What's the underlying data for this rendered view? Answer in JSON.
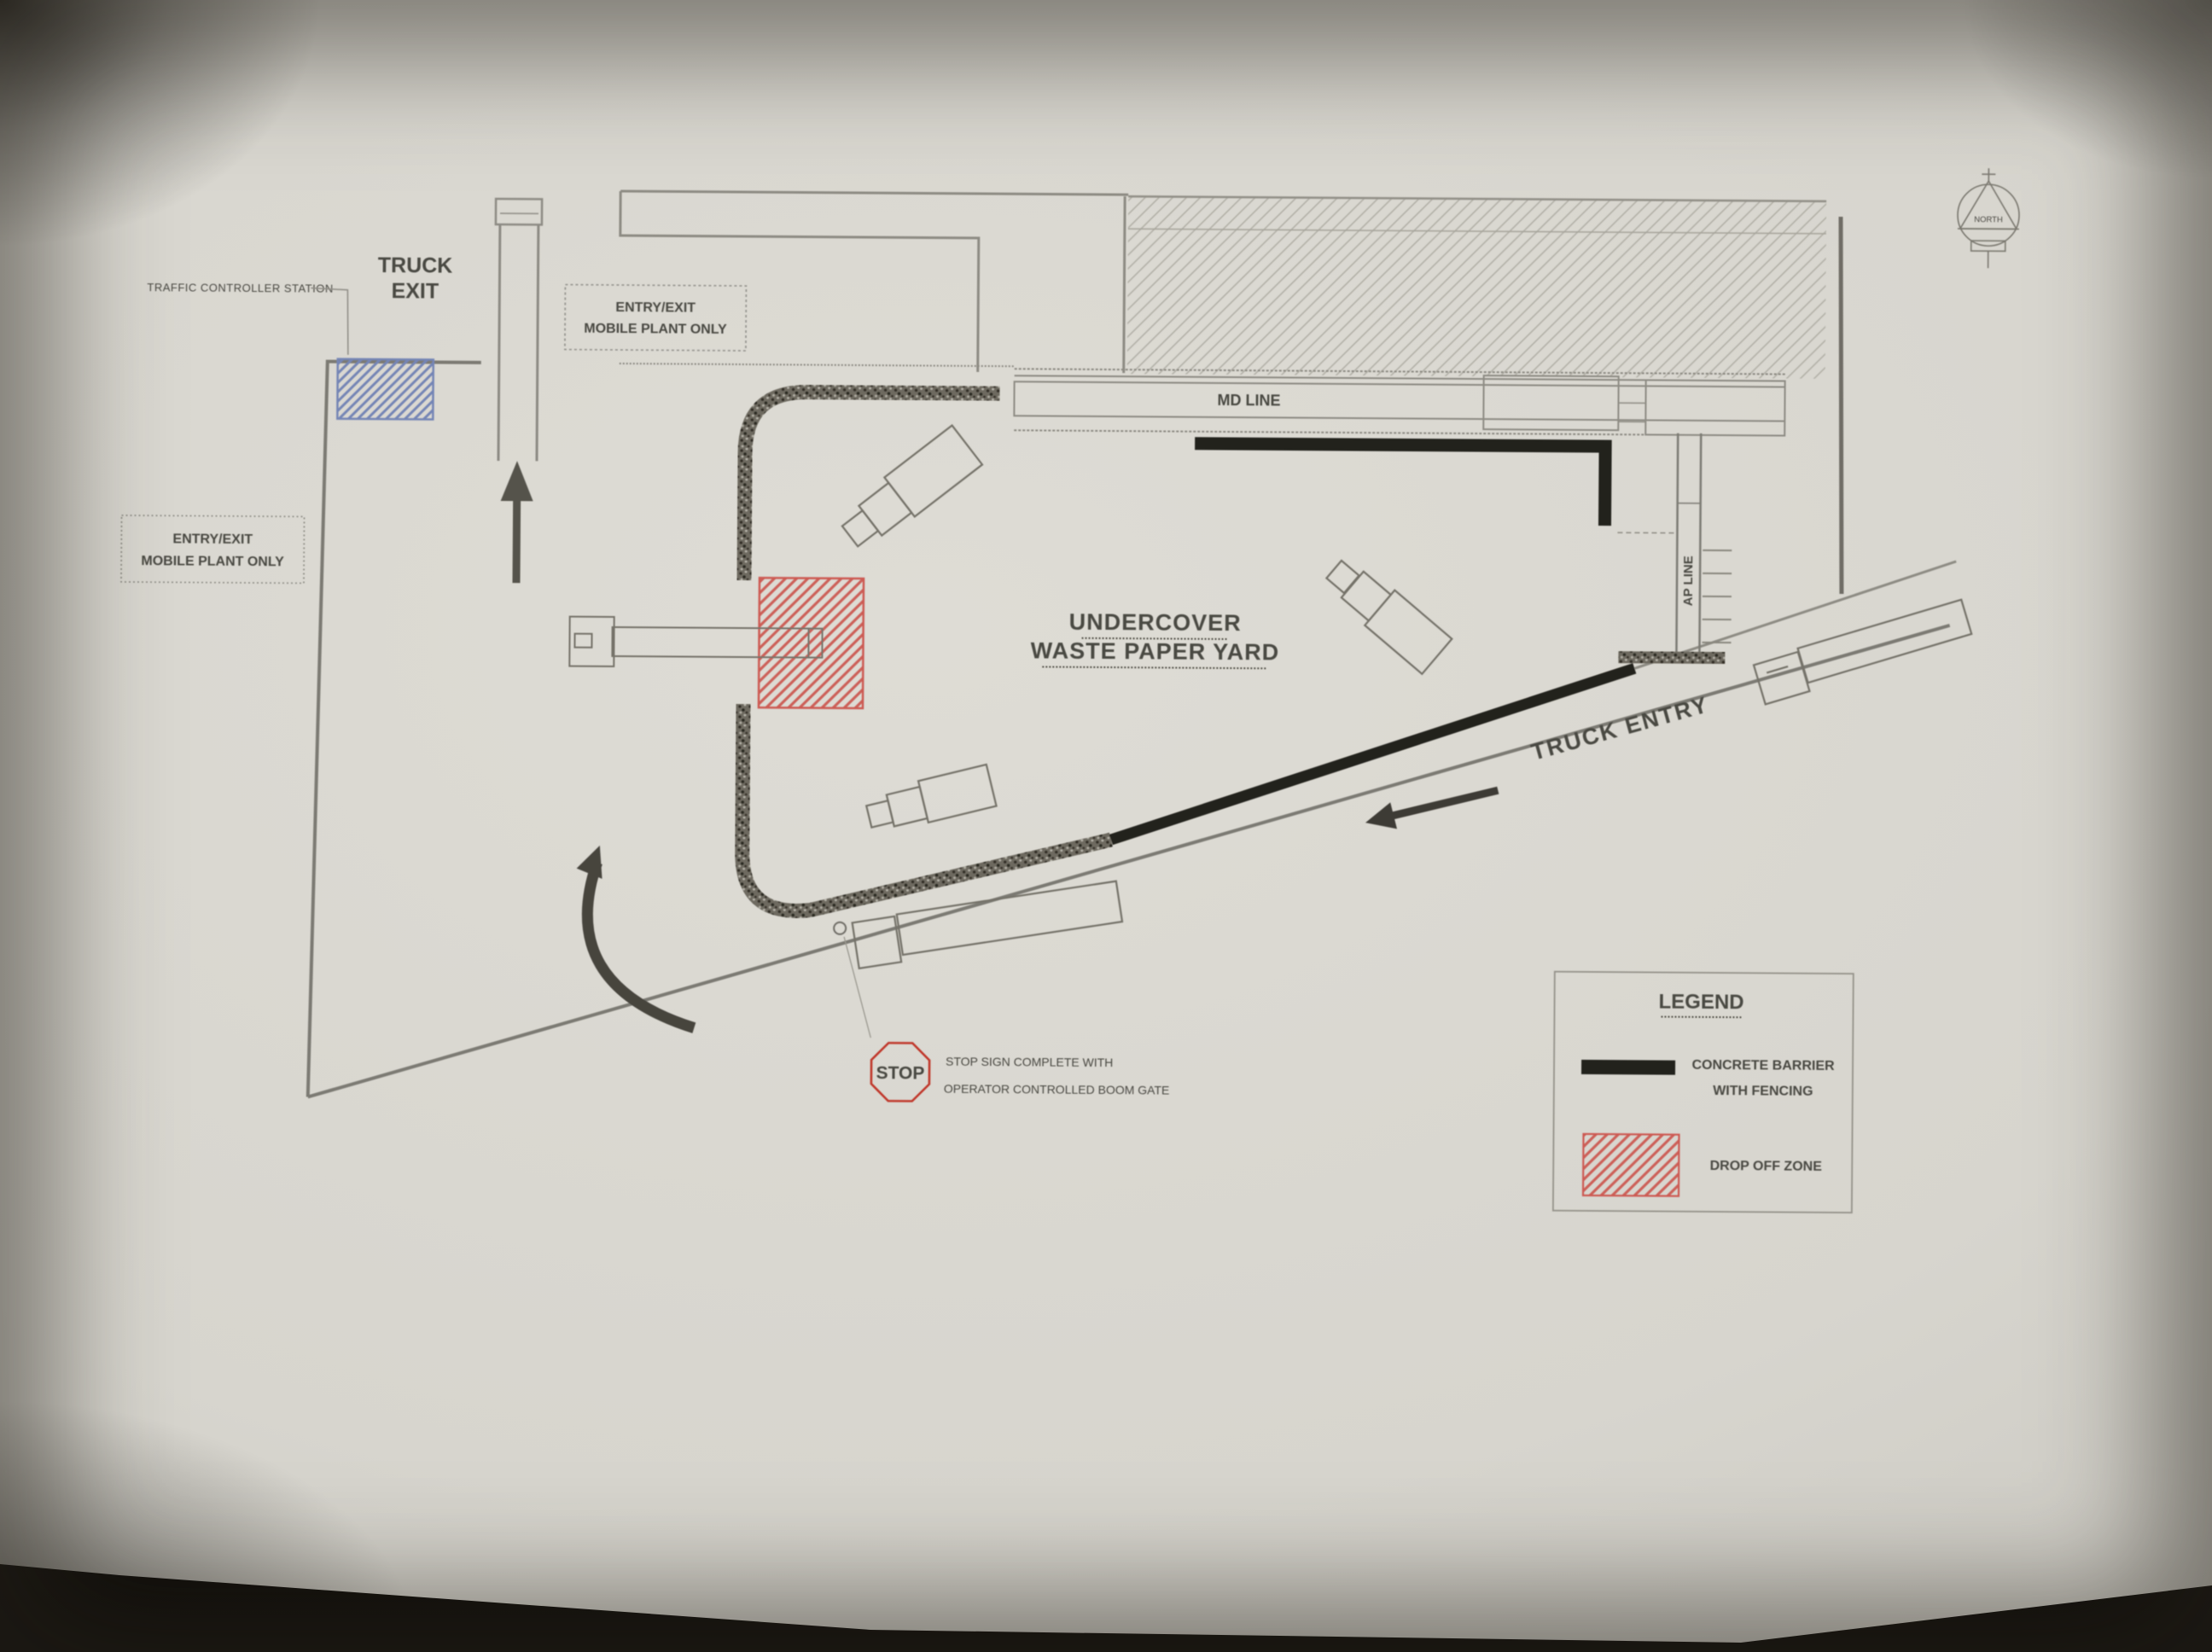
{
  "photo": {
    "surface_color": "#14110e",
    "paper_color": "#d7d5ce"
  },
  "plan": {
    "north_label": "NORTH",
    "station_label": "TRAFFIC CONTROLLER STATION",
    "truck_exit": {
      "line1": "TRUCK",
      "line2": "EXIT"
    },
    "entry_exit_top": {
      "line1": "ENTRY/EXIT",
      "line2": "MOBILE PLANT ONLY"
    },
    "entry_exit_left": {
      "line1": "ENTRY/EXIT",
      "line2": "MOBILE PLANT ONLY"
    },
    "md_line_label": "MD LINE",
    "ap_line_label": "AP LINE",
    "yard_title": {
      "line1": "UNDERCOVER",
      "line2": "WASTE PAPER YARD"
    },
    "truck_entry_label": "TRUCK ENTRY",
    "stop_sign": {
      "sign_text": "STOP",
      "note_line1": "STOP SIGN COMPLETE WITH",
      "note_line2": "OPERATOR CONTROLLED BOOM GATE"
    },
    "legend": {
      "title": "LEGEND",
      "items": [
        {
          "key": "concrete-barrier",
          "label_line1": "CONCRETE BARRIER",
          "label_line2": "WITH FENCING",
          "swatch_color": "#24211d"
        },
        {
          "key": "drop-off-zone",
          "label_line1": "DROP OFF ZONE",
          "label_line2": "",
          "swatch_color": "#cc5a52"
        }
      ]
    },
    "colors": {
      "concrete_barrier": "#24211d",
      "drop_off_zone_red": "#cc5a52",
      "station_blue": "#7585b5",
      "stop_red": "#c0392b"
    }
  }
}
